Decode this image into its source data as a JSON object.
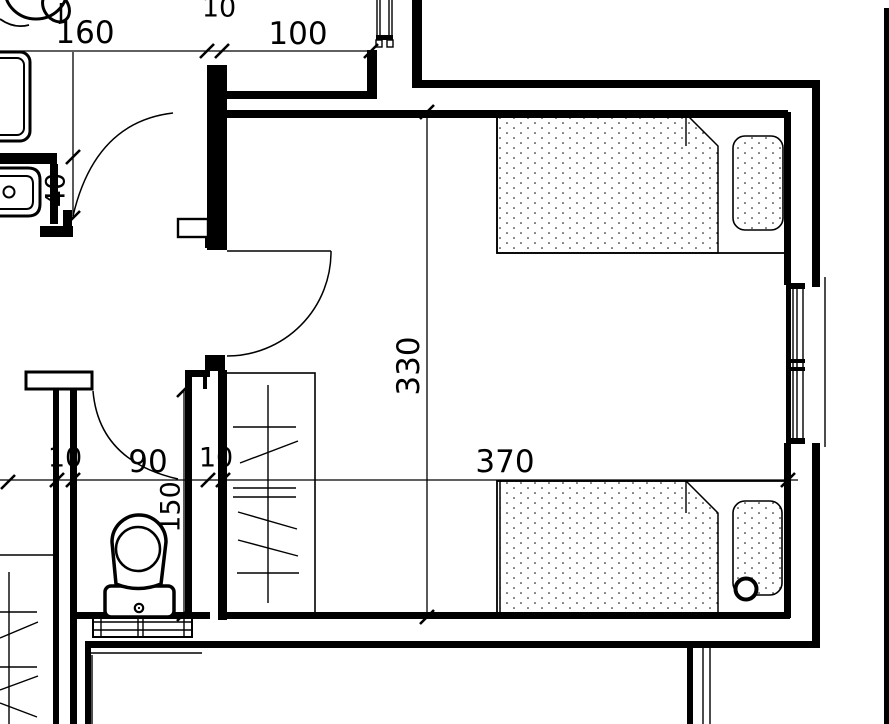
{
  "meta": {
    "drawing_type": "architectural-floor-plan",
    "rooms_visible": "bedroom-with-two-beds, wc-with-toilet, bathroom-partial, balcony"
  },
  "canvas": {
    "w": 889,
    "h": 724,
    "ink": "#000000",
    "paper": "#ffffff"
  },
  "dim_labels": [
    {
      "text": "160",
      "x": 85,
      "y": 33,
      "rot": 0,
      "size": 31
    },
    {
      "text": "10",
      "x": 219,
      "y": 8,
      "rot": 0,
      "size": 27
    },
    {
      "text": "100",
      "x": 298,
      "y": 34,
      "rot": 0,
      "size": 31
    },
    {
      "text": "40",
      "x": 56,
      "y": 190,
      "rot": -90,
      "size": 27
    },
    {
      "text": "330",
      "x": 409,
      "y": 366,
      "rot": -90,
      "size": 31
    },
    {
      "text": "370",
      "x": 505,
      "y": 462,
      "rot": 0,
      "size": 31
    },
    {
      "text": "10",
      "x": 65,
      "y": 458,
      "rot": 0,
      "size": 27
    },
    {
      "text": "90",
      "x": 148,
      "y": 462,
      "rot": 0,
      "size": 31
    },
    {
      "text": "10",
      "x": 216,
      "y": 458,
      "rot": 0,
      "size": 27
    },
    {
      "text": "150",
      "x": 171,
      "y": 507,
      "rot": -90,
      "size": 27
    }
  ],
  "layers": [
    {
      "name": "wall-outline",
      "kind": "box",
      "items": [
        {
          "x": 26,
          "y": 372,
          "w": 66,
          "h": 17,
          "sw": 3,
          "fill": "paper"
        },
        {
          "x": 178,
          "y": 219,
          "w": 30,
          "h": 18,
          "sw": 2.4,
          "fill": "paper"
        },
        {
          "x": 93,
          "y": 617,
          "w": 99,
          "h": 20,
          "sw": 2,
          "fill": "paper"
        }
      ]
    },
    {
      "name": "wall",
      "kind": "wall",
      "items": [
        [
          412,
          0,
          10,
          82
        ],
        [
          412,
          80,
          406,
          8
        ],
        [
          812,
          80,
          8,
          207
        ],
        [
          812,
          443,
          8,
          205
        ],
        [
          222,
          110,
          566,
          8
        ],
        [
          784,
          112,
          7,
          173
        ],
        [
          786,
          283,
          5,
          161
        ],
        [
          784,
          443,
          7,
          175
        ],
        [
          223,
          612,
          567,
          7
        ],
        [
          77,
          612,
          133,
          7
        ],
        [
          85,
          641,
          733,
          7
        ],
        [
          85,
          645,
          6,
          79
        ],
        [
          207,
          65,
          20,
          185
        ],
        [
          225,
          91,
          152,
          8
        ],
        [
          367,
          50,
          10,
          48
        ],
        [
          0,
          153,
          57,
          11
        ],
        [
          50,
          164,
          8,
          60
        ],
        [
          40,
          226,
          33,
          11
        ],
        [
          63,
          210,
          9,
          20
        ],
        [
          53,
          389,
          6,
          335
        ],
        [
          70,
          389,
          7,
          335
        ],
        [
          185,
          373,
          7,
          245
        ],
        [
          185,
          370,
          25,
          7
        ],
        [
          203,
          377,
          4,
          12
        ],
        [
          218,
          370,
          9,
          250
        ],
        [
          205,
          355,
          20,
          16
        ],
        [
          205,
          238,
          20,
          10
        ],
        [
          687,
          647,
          6,
          77
        ],
        [
          884,
          8,
          5,
          716
        ],
        [
          376,
          35,
          17,
          5
        ],
        [
          787,
          283,
          18,
          6
        ],
        [
          787,
          438,
          18,
          6
        ],
        [
          786,
          359,
          19,
          4
        ],
        [
          786,
          367,
          19,
          4
        ]
      ]
    },
    {
      "name": "furniture-box",
      "kind": "box",
      "items": [
        {
          "x": 225,
          "y": 373,
          "w": 90,
          "h": 240,
          "sw": 1.6
        },
        {
          "x": 497,
          "y": 114,
          "w": 291,
          "h": 139,
          "sw": 1.8
        },
        {
          "x": 497,
          "y": 481,
          "w": 291,
          "h": 137,
          "sw": 1.8
        },
        {
          "x": 733,
          "y": 136,
          "w": 50,
          "h": 94,
          "rx": 12,
          "sw": 1.6,
          "fill": "dots"
        },
        {
          "x": 733,
          "y": 501,
          "w": 49,
          "h": 94,
          "rx": 12,
          "sw": 1.6,
          "fill": "dots"
        },
        {
          "x": 105,
          "y": 586,
          "w": 69,
          "h": 31,
          "rx": 6,
          "sw": 3.5,
          "fill": "paper"
        },
        {
          "x": -14,
          "y": 52,
          "w": 44,
          "h": 89,
          "rx": 10,
          "sw": 3
        },
        {
          "x": -9,
          "y": 58,
          "w": 33,
          "h": 77,
          "rx": 7,
          "sw": 2
        },
        {
          "x": 376,
          "y": 40,
          "w": 6,
          "h": 7,
          "sw": 1.4
        },
        {
          "x": 387,
          "y": 40,
          "w": 6,
          "h": 7,
          "sw": 1.4
        }
      ]
    },
    {
      "name": "blanket",
      "kind": "poly",
      "sw": 1.5,
      "items": [
        {
          "pts": "497,114 686,114 718,146 718,253 497,253",
          "fill": "dots"
        },
        {
          "pts": "500,481 686,481 718,513 718,618 500,618",
          "fill": "dots"
        }
      ]
    },
    {
      "name": "fixture-path",
      "kind": "path",
      "items": [
        {
          "d": "M112,542 A27,27 0 1 1 166,542 L161,584 Q138,593 116,584 Z",
          "sw": 3.5,
          "fill": "paper"
        },
        {
          "d": "M0,168 L28,168 Q40,168 40,180 L40,204 Q40,216 28,216 L0,216",
          "sw": 3,
          "fill": "paper"
        },
        {
          "d": "M0,176 L26,176 Q33,176 33,184 L33,201 Q33,209 26,209 L0,209",
          "sw": 2
        },
        {
          "d": "M173,113 Q95,122 73,216",
          "sw": 1.5
        },
        {
          "d": "M331,251 A104,104 0 0 1 227,356",
          "sw": 1.5
        },
        {
          "d": "M93,391 Q99,461 178,479",
          "sw": 1.5
        },
        {
          "d": "M0,19 Q14,29 29,25",
          "sw": 1.8
        }
      ]
    },
    {
      "name": "fixture-circle",
      "kind": "circle",
      "items": [
        {
          "cx": 138,
          "cy": 549,
          "r": 22,
          "sw": 2.5
        },
        {
          "cx": 139,
          "cy": 608,
          "r": 4.2,
          "sw": 2.2
        },
        {
          "cx": 139,
          "cy": 608,
          "r": 1.1,
          "sw": 0,
          "fill": "ink"
        },
        {
          "cx": 9,
          "cy": 192,
          "r": 5.5,
          "sw": 2
        },
        {
          "cx": 746,
          "cy": 589,
          "r": 10.5,
          "sw": 4,
          "fill": "paper"
        }
      ]
    },
    {
      "name": "fixture-ellipse",
      "kind": "ellipse",
      "items": [
        {
          "cx": 36,
          "cy": -10,
          "rx": 31,
          "ry": 29,
          "sw": 3
        },
        {
          "cx": 56,
          "cy": 7,
          "rx": 12,
          "ry": 16,
          "sw": 3,
          "rot": -35
        }
      ]
    },
    {
      "name": "detail-line",
      "kind": "line",
      "sw": 1.4,
      "items": [
        [
          686,
          114,
          686,
          146
        ],
        [
          686,
          481,
          686,
          513
        ],
        [
          227,
          251,
          331,
          251
        ],
        [
          268,
          385,
          268,
          603
        ],
        [
          233,
          427,
          296,
          427
        ],
        [
          233,
          488,
          296,
          488
        ],
        [
          233,
          497,
          296,
          497
        ],
        [
          237,
          573,
          299,
          573
        ],
        [
          240,
          463,
          298,
          441
        ],
        [
          238,
          512,
          297,
          529
        ],
        [
          238,
          540,
          298,
          556
        ],
        [
          0,
          555,
          53,
          555
        ],
        [
          9,
          572,
          9,
          724
        ],
        [
          0,
          612,
          37,
          612
        ],
        [
          0,
          667,
          37,
          667
        ],
        [
          0,
          638,
          38,
          622
        ],
        [
          0,
          690,
          38,
          676
        ],
        [
          0,
          703,
          37,
          717
        ],
        [
          90,
          653,
          202,
          653
        ],
        [
          92,
          655,
          92,
          724
        ],
        [
          703,
          647,
          703,
          724
        ],
        [
          710,
          647,
          710,
          724
        ],
        [
          793,
          289,
          793,
          438
        ],
        [
          797,
          289,
          797,
          438
        ],
        [
          803,
          289,
          803,
          438
        ],
        [
          825,
          277,
          825,
          447
        ],
        [
          377,
          0,
          377,
          35
        ],
        [
          380,
          0,
          380,
          35
        ],
        [
          389,
          0,
          389,
          35
        ],
        [
          392,
          0,
          392,
          35
        ],
        [
          93,
          622,
          192,
          622
        ],
        [
          93,
          630,
          192,
          630
        ],
        [
          101,
          617,
          101,
          637
        ],
        [
          138,
          617,
          138,
          637
        ],
        [
          143,
          617,
          143,
          637
        ],
        [
          184,
          617,
          184,
          637
        ],
        [
          61,
          3,
          61,
          22,
          2.5
        ]
      ]
    },
    {
      "name": "dimension-line",
      "kind": "line",
      "sw": 1.3,
      "items": [
        [
          0,
          51,
          377,
          51
        ],
        [
          73,
          52,
          73,
          218
        ],
        [
          0,
          480,
          798,
          480
        ],
        [
          184,
          390,
          184,
          616
        ],
        [
          427,
          112,
          427,
          617
        ]
      ]
    },
    {
      "name": "dimension-tick",
      "kind": "tick",
      "sw": 2.6,
      "len": 7,
      "items": [
        [
          207,
          51
        ],
        [
          222,
          51
        ],
        [
          371,
          51
        ],
        [
          73,
          157
        ],
        [
          73,
          218
        ],
        [
          8,
          482
        ],
        [
          57,
          480
        ],
        [
          73,
          480
        ],
        [
          208,
          480
        ],
        [
          223,
          480
        ],
        [
          788,
          480
        ],
        [
          184,
          390
        ],
        [
          184,
          614
        ],
        [
          427,
          112
        ],
        [
          427,
          617
        ]
      ]
    }
  ]
}
